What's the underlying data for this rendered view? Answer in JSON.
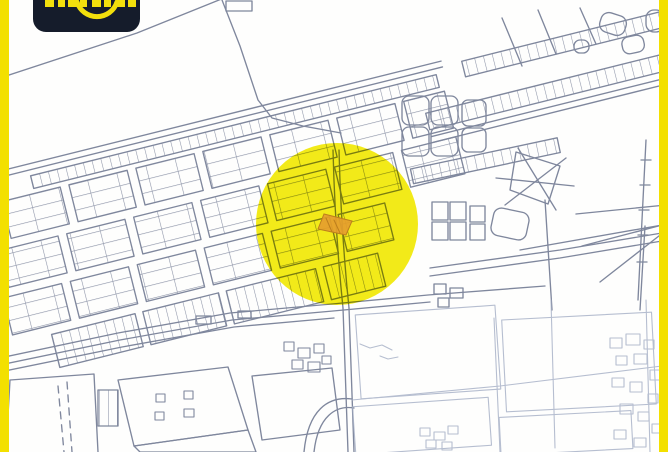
{
  "frame": {
    "color": "#f3e000"
  },
  "logo": {
    "bg_color": "#151c2b",
    "accent_color": "#f2df0c"
  },
  "map": {
    "style": "cadastral-line-drawing",
    "background": "#fefefd",
    "line_color": "#6e7790",
    "faint_line_color": "#a4aec5",
    "highlight_circle": {
      "color": "#f2e900",
      "opacity": "0.9",
      "cx": "337",
      "cy": "224",
      "r": "81"
    },
    "selected_parcel": {
      "fill": "#e59d2e",
      "stroke": "#bd7f1d"
    }
  }
}
